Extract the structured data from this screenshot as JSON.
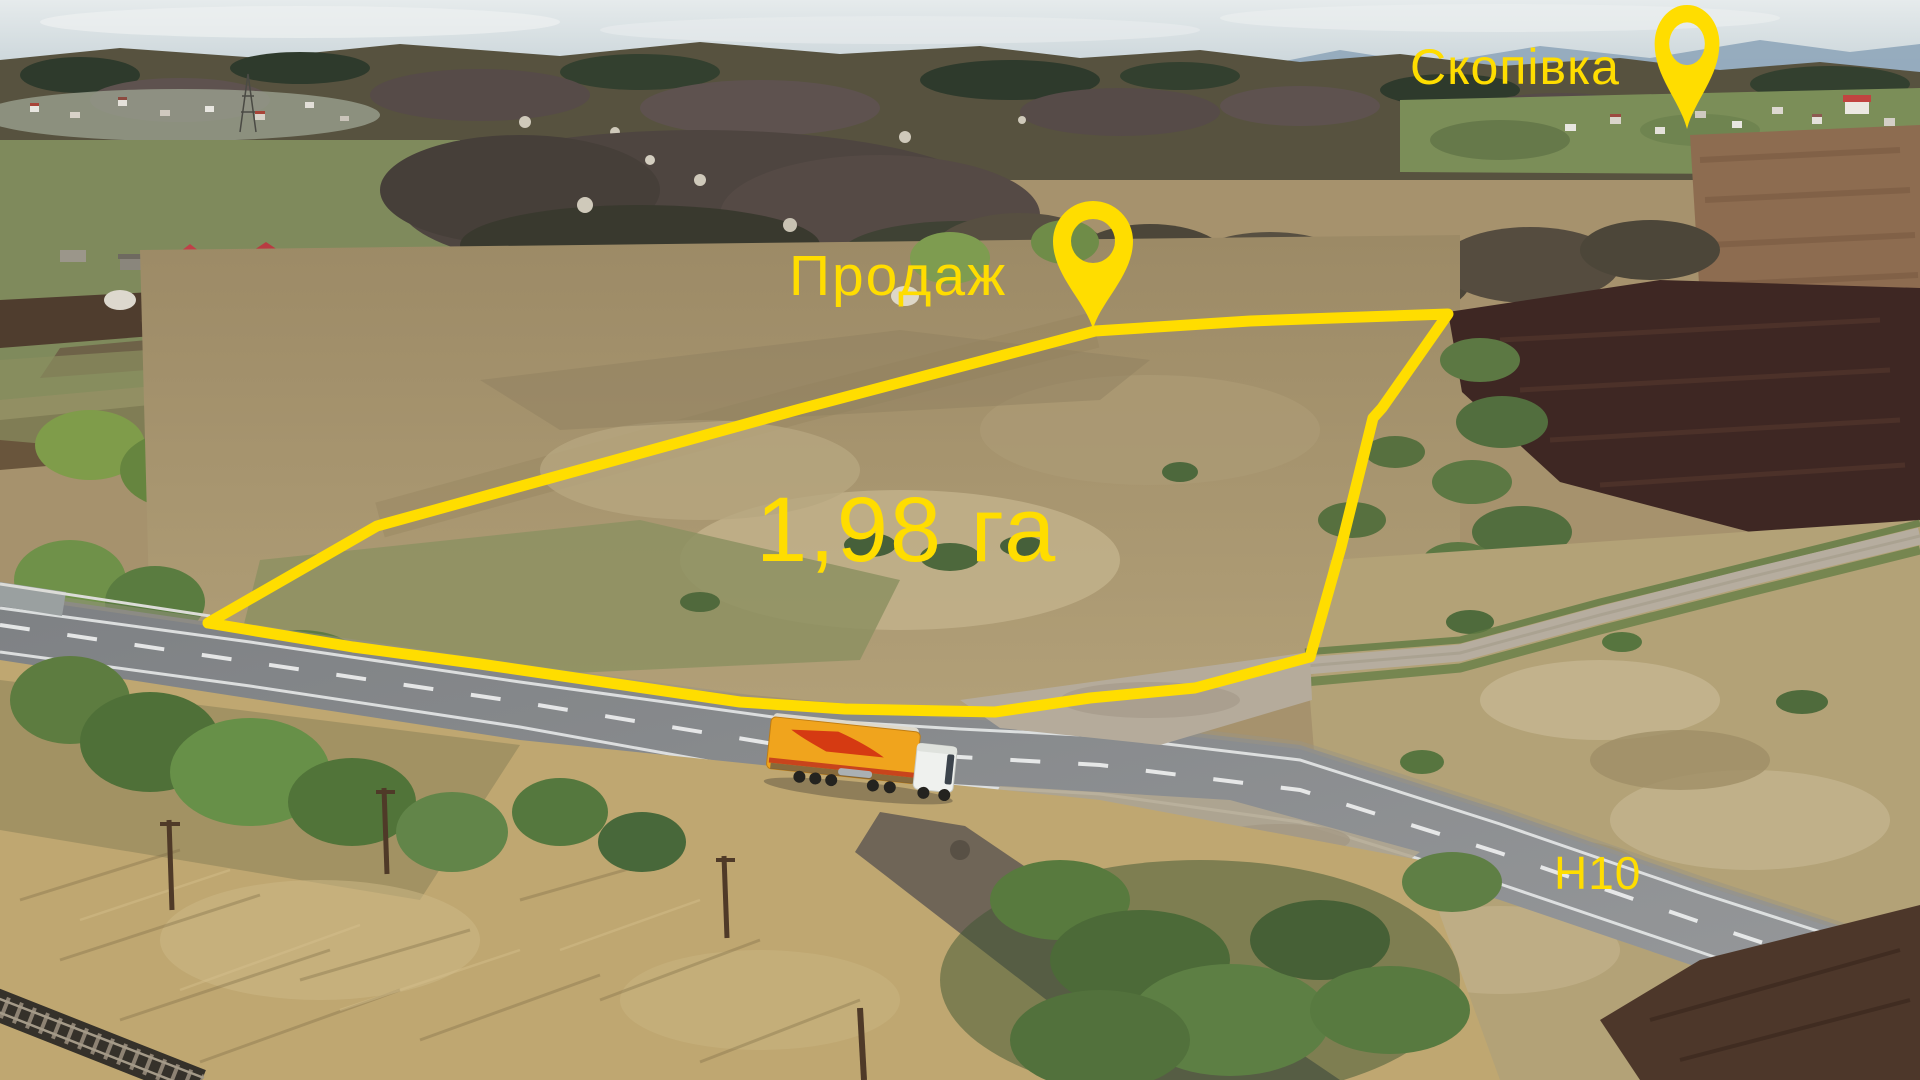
{
  "title": "Aerial drone photo of land plot for sale",
  "labels": {
    "village": "Скопівка",
    "sale": "Продаж",
    "area": "1,98 га",
    "road": "Н10"
  },
  "colors": {
    "annotation_yellow": "#FFDD00",
    "sky": "#D9E1E5",
    "mountains": "#7E98AC",
    "road_asphalt": "#8C8E90",
    "plowed_field": "#3E2723",
    "dry_field": "#A6926D",
    "truck_trailer": "#F0A41D",
    "truck_swoosh": "#D53A12",
    "truck_cab": "#EFF1EE"
  },
  "icons": {
    "village_pin": "map-pin-icon",
    "sale_pin": "map-pin-icon"
  }
}
